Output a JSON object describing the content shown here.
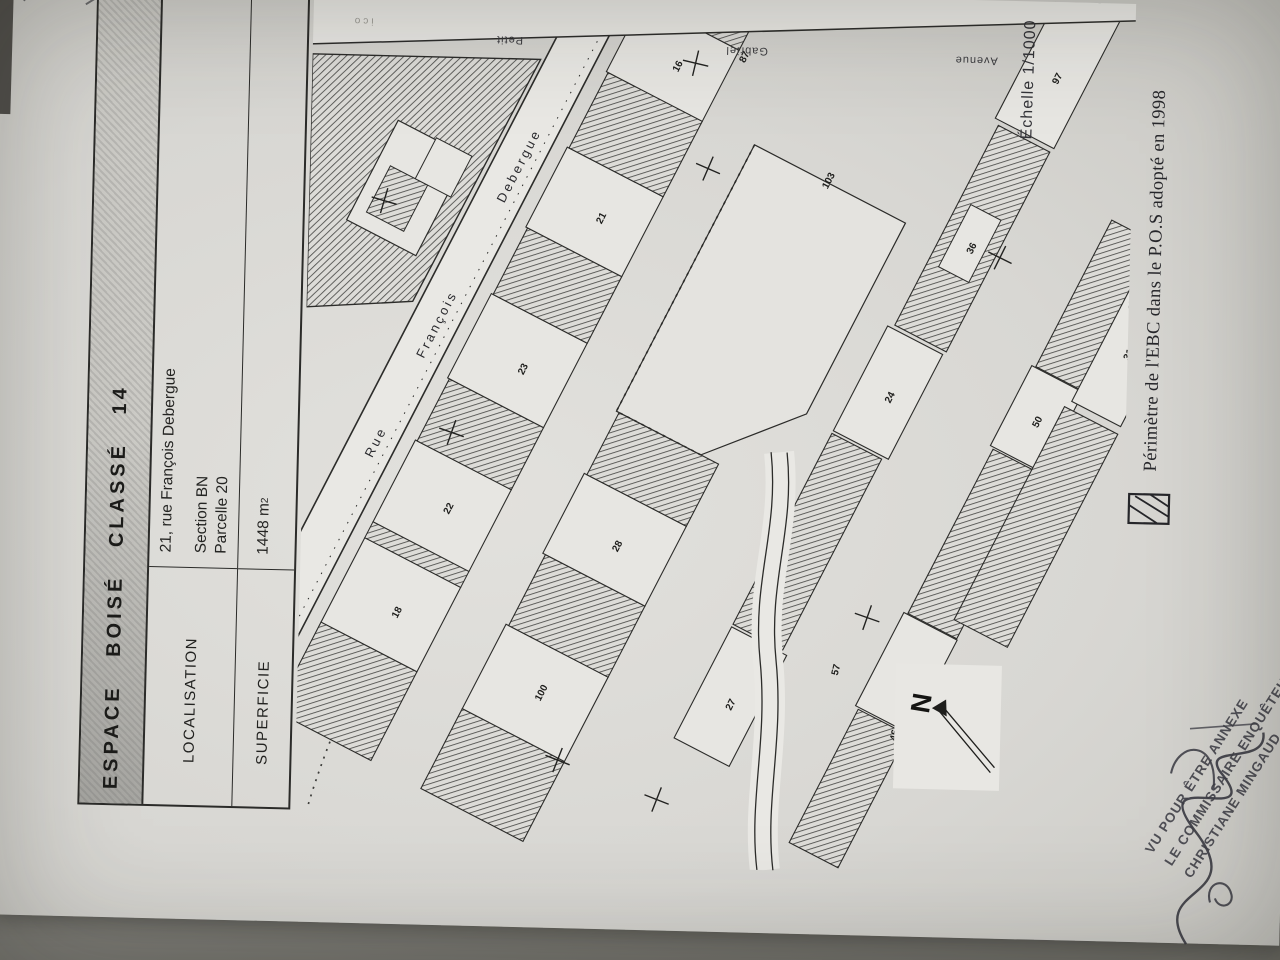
{
  "table": {
    "title": "ESPACE BOISÉ CLASSÉ  14",
    "rows": [
      {
        "label": "LOCALISATION",
        "value_lines": [
          "21, rue François Debergue",
          "Section BN",
          "Parcelle 20"
        ]
      },
      {
        "label": "SUPERFICIE",
        "value": "1448 m",
        "value_sup": "2"
      }
    ]
  },
  "map": {
    "scale": "Échelle 1/1000",
    "street_main": {
      "part1": "Rue",
      "part2": "François",
      "part3": "Debergue"
    },
    "side_streets": [
      "Petit",
      "Gabriel",
      "Avenue"
    ],
    "faint_label": "ico",
    "compass_label": "N",
    "parcel_numbers": [
      "18",
      "22",
      "23",
      "21",
      "16",
      "100",
      "28",
      "27",
      "24",
      "36",
      "97",
      "19",
      "50",
      "31",
      "57",
      "46",
      "103",
      "87"
    ]
  },
  "legend": {
    "caption": "Périmètre de l'EBC dans le P.O.S adopté en 1998"
  },
  "stamp": {
    "lines": [
      "VU POUR ÊTRE ANNEXE",
      "LE COMMISSAIRE ENQUÊTEUR",
      "CHRISTIANE MINGAUD"
    ]
  },
  "colors": {
    "paper": "#d9d8d4",
    "ink": "#2a2a28",
    "floor": "#8d8c86"
  }
}
